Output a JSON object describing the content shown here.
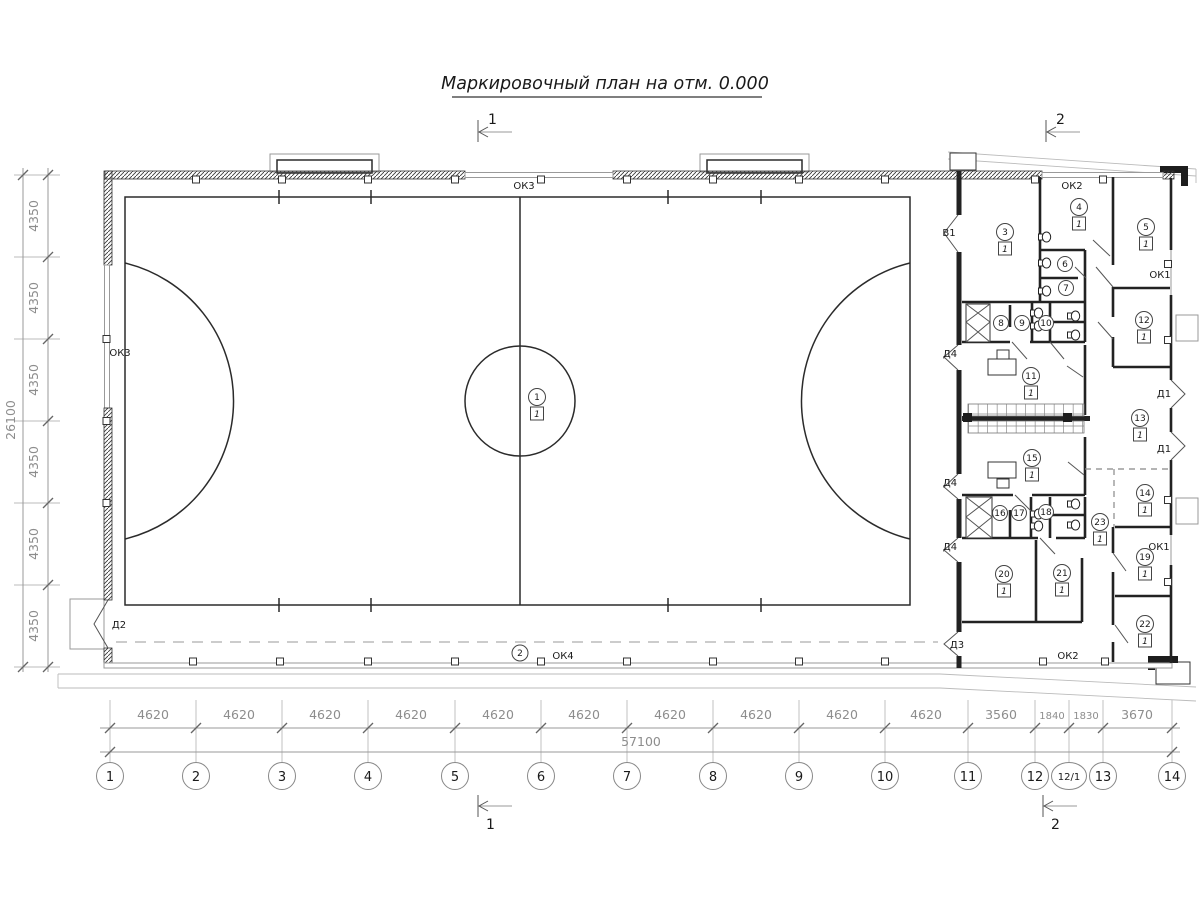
{
  "title": "Маркировочный план на отм. 0.000",
  "section_marks": {
    "s1": "1",
    "s2": "2"
  },
  "axes": {
    "bottom": [
      "1",
      "2",
      "3",
      "4",
      "5",
      "6",
      "7",
      "8",
      "9",
      "10",
      "11",
      "12",
      "12/1",
      "13",
      "14"
    ]
  },
  "dims": {
    "bottom_segments": [
      "4620",
      "4620",
      "4620",
      "4620",
      "4620",
      "4620",
      "4620",
      "4620",
      "4620",
      "4620",
      "3560",
      "1840",
      "1830",
      "3670"
    ],
    "bottom_total": "57100",
    "left_segments": [
      "4350",
      "4350",
      "4350",
      "4350",
      "4350",
      "4350"
    ],
    "left_total": "26100"
  },
  "openings": {
    "ok1": "ОК1",
    "ok2": "ОК2",
    "ok3": "ОК3",
    "ok4": "ОК4",
    "v1": "В1",
    "d1": "Д1",
    "d2": "Д2",
    "d3": "Д3",
    "d4": "Д4"
  },
  "rooms": {
    "r1": {
      "num": "1",
      "floor": "1"
    },
    "r2": {
      "num": "2"
    },
    "r3": {
      "num": "3",
      "floor": "1"
    },
    "r4": {
      "num": "4",
      "floor": "1"
    },
    "r5": {
      "num": "5",
      "floor": "1"
    },
    "r6": {
      "num": "6"
    },
    "r7": {
      "num": "7"
    },
    "r8": {
      "num": "8"
    },
    "r9": {
      "num": "9"
    },
    "r10": {
      "num": "10"
    },
    "r11": {
      "num": "11",
      "floor": "1"
    },
    "r12": {
      "num": "12",
      "floor": "1"
    },
    "r13": {
      "num": "13",
      "floor": "1"
    },
    "r14": {
      "num": "14",
      "floor": "1"
    },
    "r15": {
      "num": "15",
      "floor": "1"
    },
    "r16": {
      "num": "16"
    },
    "r17": {
      "num": "17"
    },
    "r18": {
      "num": "18"
    },
    "r19": {
      "num": "19",
      "floor": "1"
    },
    "r20": {
      "num": "20",
      "floor": "1"
    },
    "r21": {
      "num": "21",
      "floor": "1"
    },
    "r22": {
      "num": "22",
      "floor": "1"
    },
    "r23": {
      "num": "23",
      "floor": "1"
    }
  }
}
